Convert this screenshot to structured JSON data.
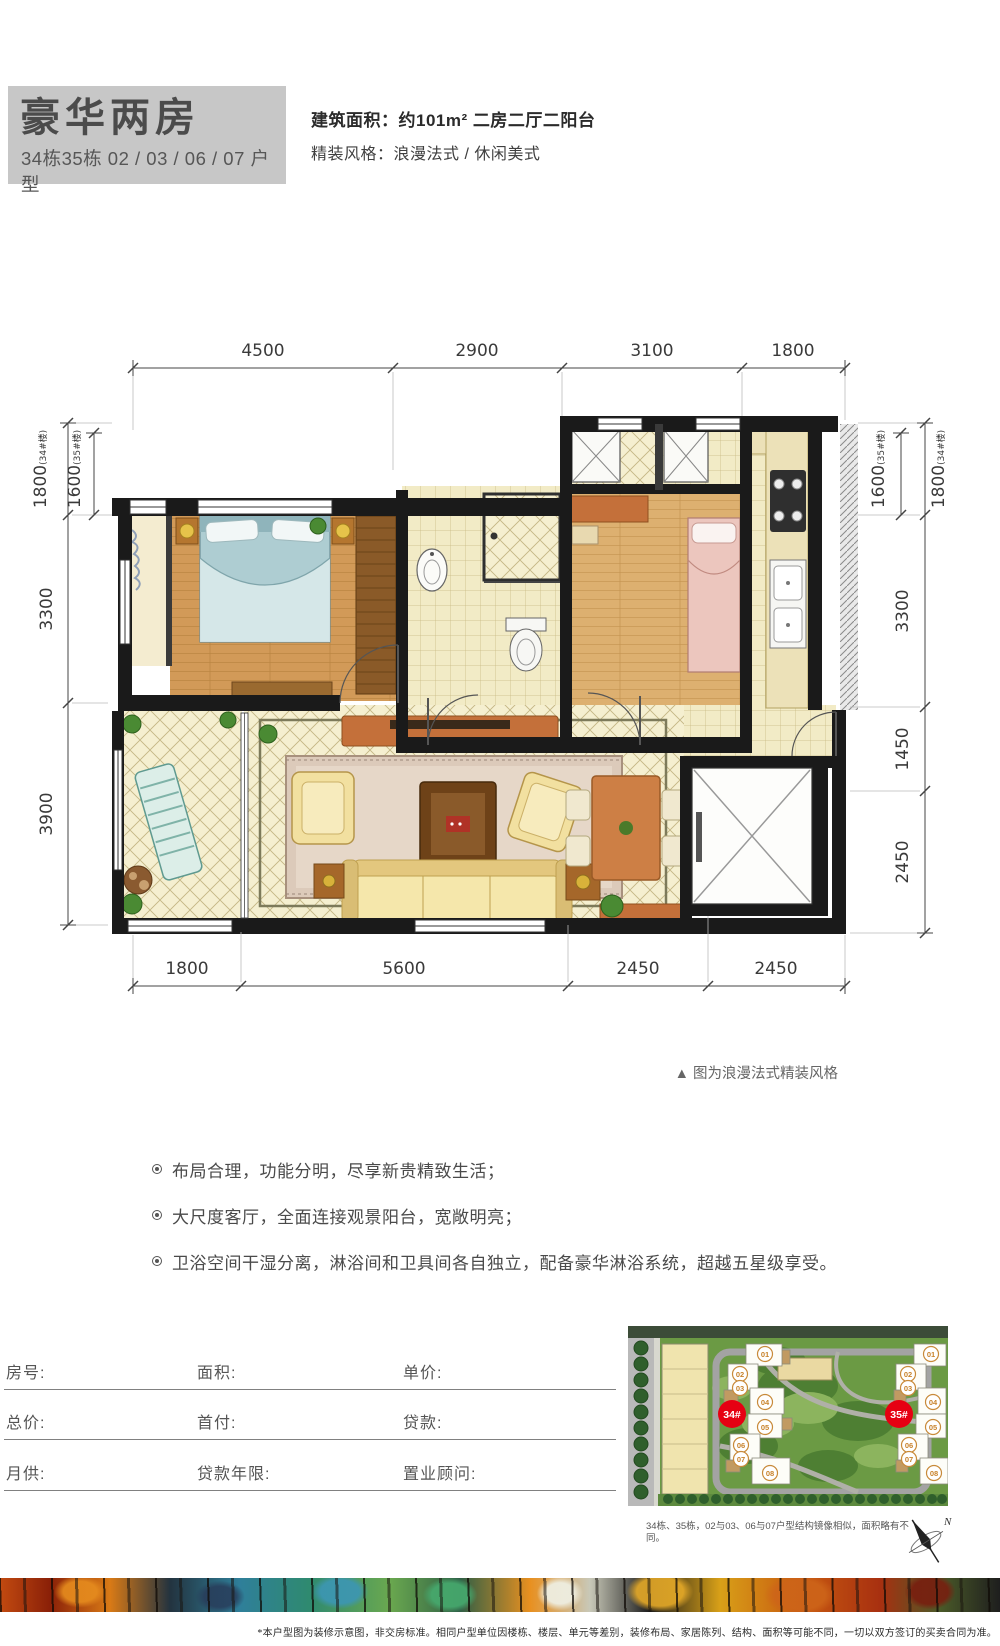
{
  "header": {
    "title": "豪华两房",
    "subtitle": "34栋35栋 02 / 03 / 06 / 07 户型",
    "area_line": "建筑面积：约101m²  二房二厅二阳台",
    "style_line": "精装风格：浪漫法式 / 休闲美式"
  },
  "floor_plan": {
    "caption": "▲ 图为浪漫法式精装风格",
    "dims_top": [
      "4500",
      "2900",
      "3100",
      "1800"
    ],
    "dims_bottom": [
      "1800",
      "5600",
      "2450",
      "2450"
    ],
    "dims_left": [
      {
        "value": "1800",
        "note": "(34#楼)"
      },
      {
        "value": "1600",
        "note": "(35#楼)"
      },
      {
        "value": "3300",
        "note": ""
      },
      {
        "value": "3900",
        "note": ""
      }
    ],
    "dims_right": [
      {
        "value": "1600",
        "note": "(35#楼)"
      },
      {
        "value": "1800",
        "note": "(34#楼)"
      },
      {
        "value": "3300",
        "note": ""
      },
      {
        "value": "1450",
        "note": ""
      },
      {
        "value": "2450",
        "note": ""
      }
    ]
  },
  "features": [
    "布局合理，功能分明，尽享新贵精致生活；",
    "大尺度客厅，全面连接观景阳台，宽敞明亮；",
    "卫浴空间干湿分离，淋浴间和卫具间各自独立，配备豪华淋浴系统，超越五星级享受。"
  ],
  "form": {
    "rows": [
      [
        "房号:",
        "面积:",
        "单价:"
      ],
      [
        "总价:",
        "首付:",
        "贷款:"
      ],
      [
        "月供:",
        "贷款年限:",
        "置业顾问:"
      ]
    ]
  },
  "site_plan": {
    "building_34": "34#",
    "building_35": "35#",
    "badge_color": "#e60012",
    "unit_labels": [
      "01",
      "02",
      "03",
      "04",
      "05",
      "06",
      "07",
      "08"
    ],
    "caption": "34栋、35栋，02与03、06与07户型结构镜像相似，面积略有不同。",
    "compass": "N"
  },
  "disclaimer": "*本户型图为装修示意图，非交房标准。相同户型单位因楼栋、楼层、单元等差别，装修布局、家居陈列、结构、面积等可能不同，一切以双方签订的买卖合同为准。"
}
